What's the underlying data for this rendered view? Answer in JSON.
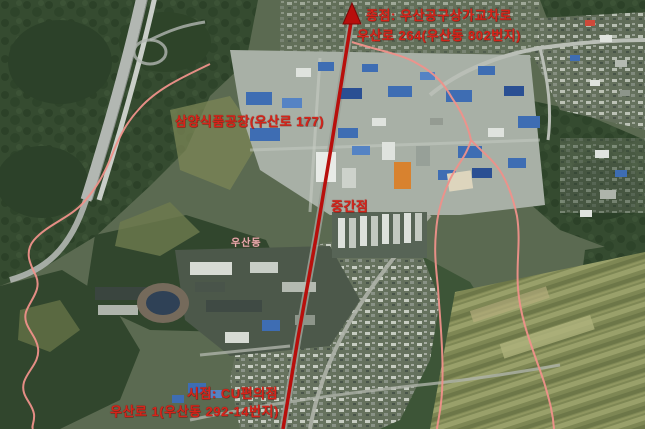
{
  "map": {
    "labels": {
      "end_line1": "종점: 우산공구상가교차로",
      "end_line2": "우산로 264(우산동 802번지)",
      "factory": "삼양식품공장(우산로 177)",
      "midpoint": "중간점",
      "district": "우산동",
      "start_line1": "시점: CU편의점",
      "start_line2": "우산로 1(우산동 292-14번지)"
    },
    "icons": {
      "route_arrow": "route-arrow-icon"
    },
    "colors": {
      "annotation_red": "#d6241a",
      "route_red": "#b80f0c",
      "boundary_pink": "#ef918a",
      "district_label_pink": "#e7abae"
    }
  }
}
